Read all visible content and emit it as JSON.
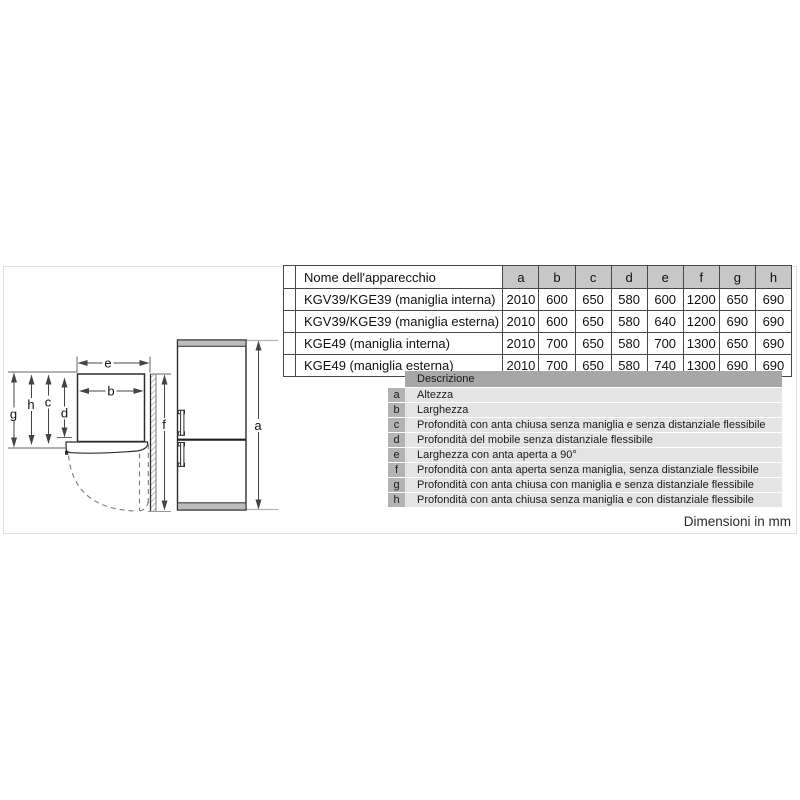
{
  "table": {
    "name_header": "Nome dell'apparecchio",
    "columns": [
      "a",
      "b",
      "c",
      "d",
      "e",
      "f",
      "g",
      "h"
    ],
    "rows": [
      {
        "name": "KGV39/KGE39 (maniglia interna)",
        "values": [
          "2010",
          "600",
          "650",
          "580",
          "600",
          "1200",
          "650",
          "690"
        ]
      },
      {
        "name": "KGV39/KGE39 (maniglia esterna)",
        "values": [
          "2010",
          "600",
          "650",
          "580",
          "640",
          "1200",
          "690",
          "690"
        ]
      },
      {
        "name": "KGE49 (maniglia interna)",
        "values": [
          "2010",
          "700",
          "650",
          "580",
          "700",
          "1300",
          "650",
          "690"
        ]
      },
      {
        "name": "KGE49 (maniglia esterna)",
        "values": [
          "2010",
          "700",
          "650",
          "580",
          "740",
          "1300",
          "690",
          "690"
        ]
      }
    ]
  },
  "legend": {
    "header": "Descrizione",
    "items": [
      {
        "key": "a",
        "text": "Altezza"
      },
      {
        "key": "b",
        "text": "Larghezza"
      },
      {
        "key": "c",
        "text": "Profondità con anta chiusa senza maniglia e senza distanziale flessibile"
      },
      {
        "key": "d",
        "text": "Profondità del mobile senza distanziale flessibile"
      },
      {
        "key": "e",
        "text": "Larghezza con anta aperta a 90°"
      },
      {
        "key": "f",
        "text": "Profondità con anta aperta senza maniglia, senza distanziale flessibile"
      },
      {
        "key": "g",
        "text": "Profondità con anta chiusa con maniglia e senza distanziale flessibile"
      },
      {
        "key": "h",
        "text": "Profondità con anta chiusa senza maniglia e con distanziale flessibile"
      }
    ]
  },
  "diagram": {
    "labels": {
      "a": "a",
      "b": "b",
      "c": "c",
      "d": "d",
      "e": "e",
      "f": "f",
      "g": "g",
      "h": "h"
    }
  },
  "footer": {
    "note": "Dimensioni in mm"
  },
  "colors": {
    "table_header_bg": "#c7c7c7",
    "legend_header_bg": "#a7a7a7",
    "legend_key_bg": "#b3b3b3",
    "legend_row_bg": "#e4e4e4",
    "fridge_cap_gray": "#bcbcbc",
    "line_dark": "#2e2e2e",
    "frame_border": "#e0e0e0"
  }
}
